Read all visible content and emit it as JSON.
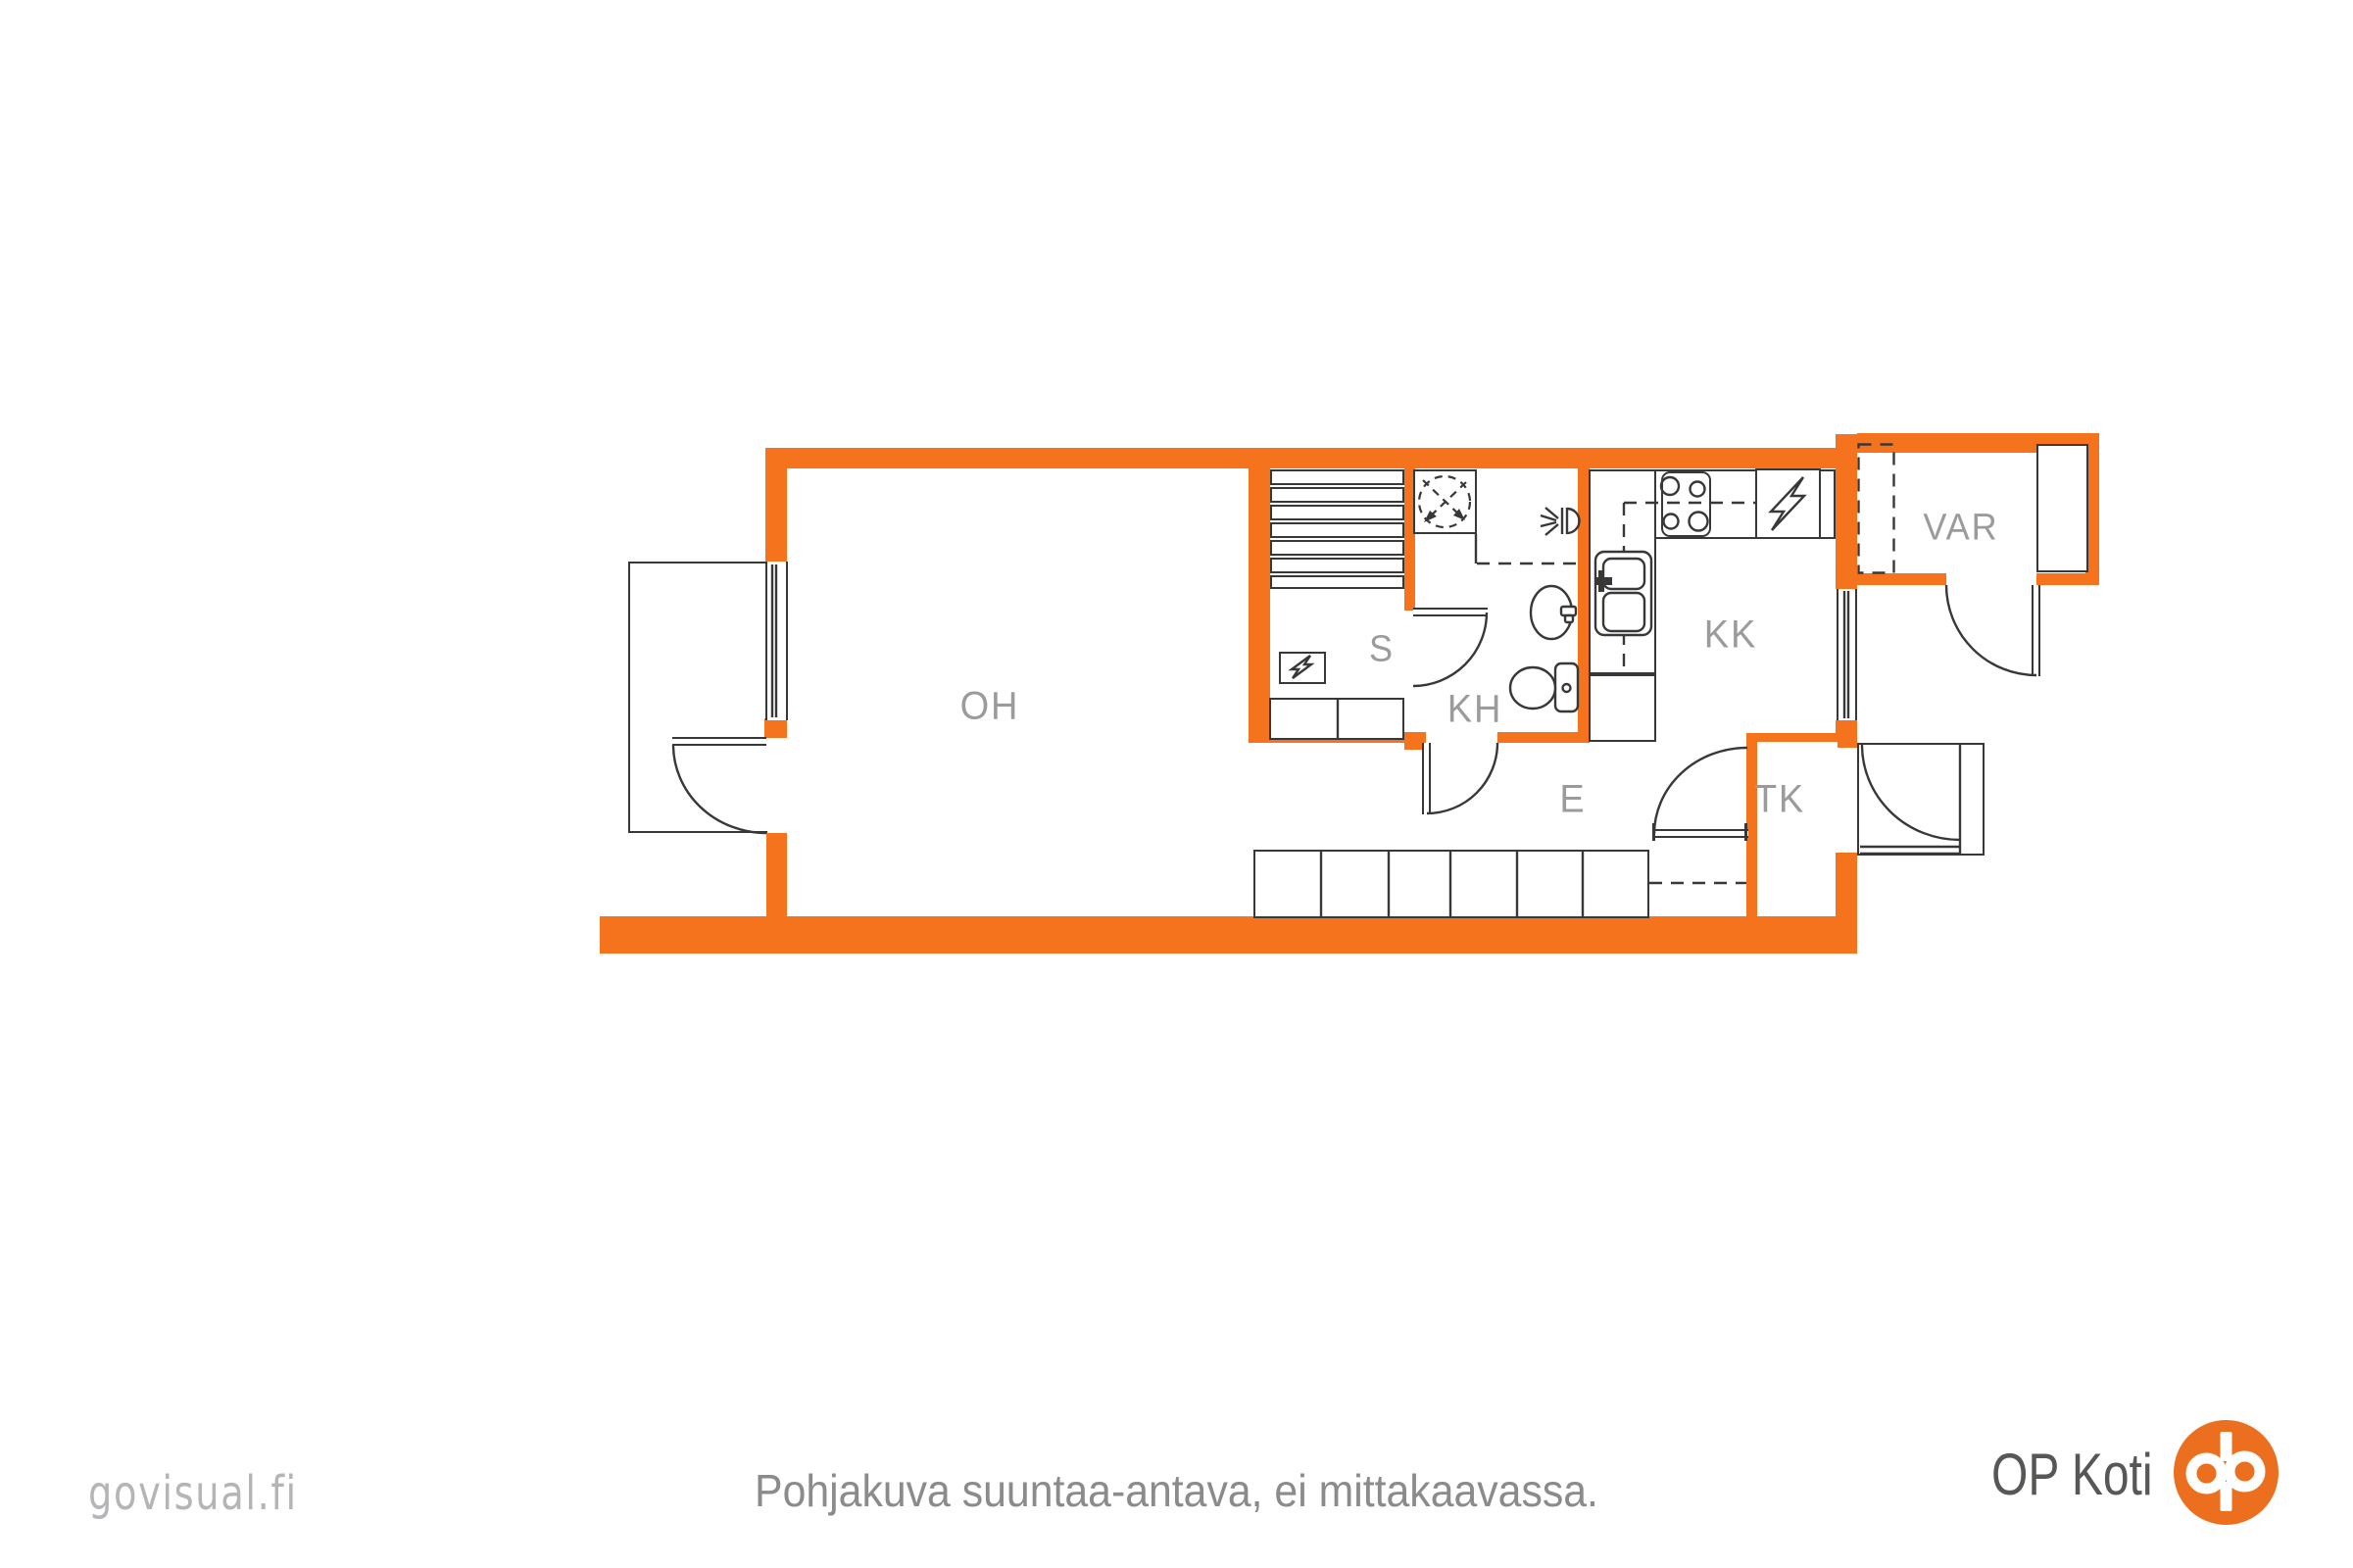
{
  "rooms": [
    {
      "id": "oh",
      "label": "OH"
    },
    {
      "id": "s",
      "label": "S"
    },
    {
      "id": "kh",
      "label": "KH"
    },
    {
      "id": "kk",
      "label": "KK"
    },
    {
      "id": "e",
      "label": "E"
    },
    {
      "id": "tk",
      "label": "TK"
    },
    {
      "id": "var",
      "label": "VAR"
    }
  ],
  "footer": {
    "disclaimer": "Pohjakuva suuntaa-antava, ei mittakaavassa.",
    "watermark": "govisual.fi",
    "brand_text": "OP Koti"
  },
  "colors": {
    "wall_orange": "#F6731E",
    "logo_orange": "#EB6F1E",
    "room_label_gray": "#9B9B9B",
    "disclaimer_gray": "#8B8B8B",
    "watermark_gray": "#B5B5B7",
    "brand_gray": "#575756",
    "line_dark": "#383838"
  },
  "icons": {
    "s_panel": "lightning-bolt",
    "kk_panel": "lightning-bolt",
    "shower": "shower-drain-dashed-circle",
    "wall_light": "wall-light-sconce",
    "toilet": "toilet",
    "washbasin": "washbasin",
    "kitchen_sink": "double-basin-sink",
    "stove": "four-burner-stove",
    "brand_logo": "op-group-monogram"
  }
}
